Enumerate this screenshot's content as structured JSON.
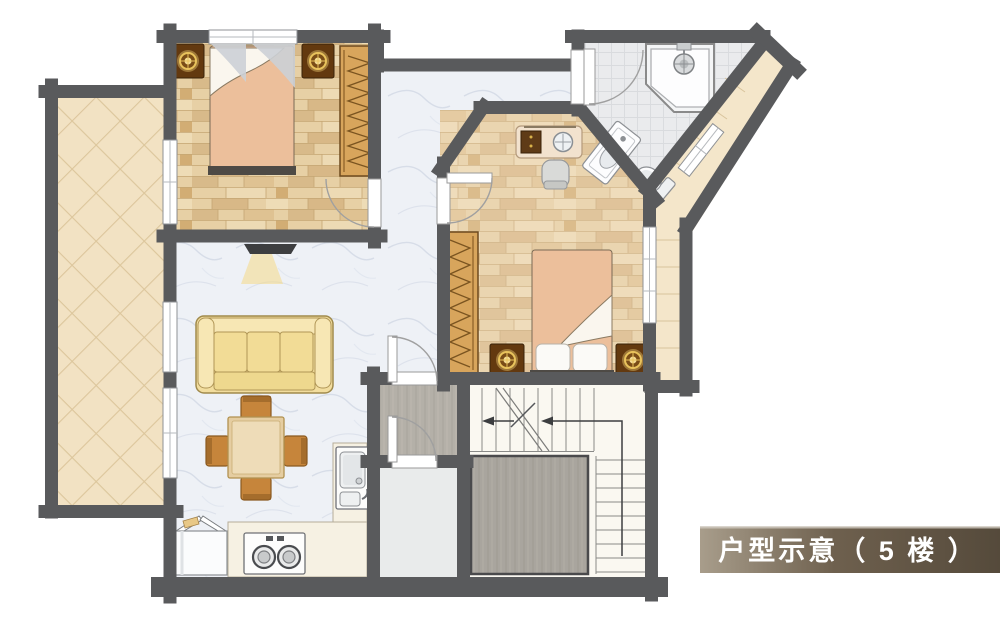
{
  "banner": {
    "label": "户型示意（ 5 楼 ）",
    "gradient_from": "#a89d8b",
    "gradient_mid": "#6e604e",
    "gradient_to": "#554a3b",
    "text_color": "#ffffff"
  },
  "palette": {
    "wall": "#595a5c",
    "bed_blanket": "#ecbf9b",
    "sofa": "#f2dd9e",
    "wardrobe": "#d8a55c",
    "nightstand": "#63390f",
    "chair_wood": "#c6853b",
    "counter": "#f6f1e3",
    "table_wood": "#e5cda1",
    "marble_floor": "#eef1f6",
    "terrace_tile": "#f2e2c3",
    "bath_tile": "#eaebed",
    "landing_floor": "#b4b0a8",
    "stair_floor": "#faf8f1"
  }
}
